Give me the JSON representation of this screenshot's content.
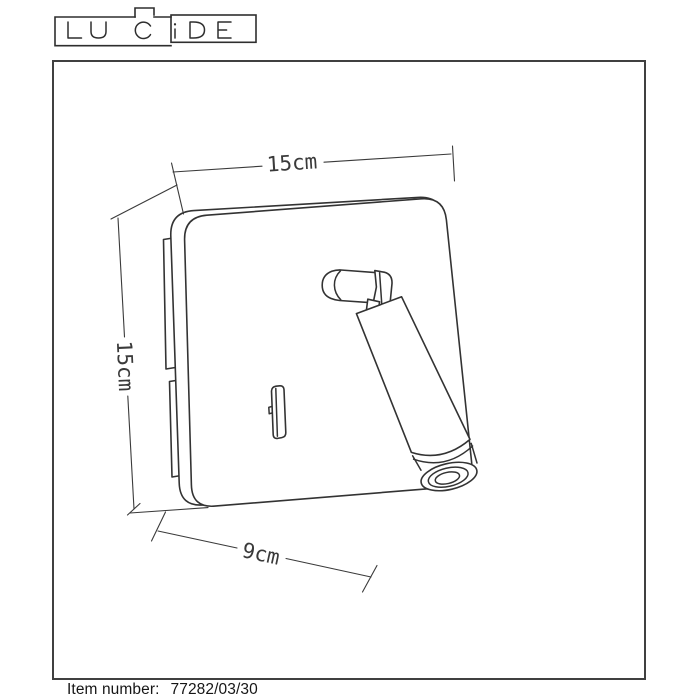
{
  "brand": {
    "name": "LUCIDE"
  },
  "dimensions": {
    "width": "15cm",
    "height": "15cm",
    "depth": "9cm"
  },
  "footer": {
    "item_label": "Item number:",
    "item_value": "77282/03/30"
  },
  "colors": {
    "line": "#333333",
    "dimension_line": "#3a3a3a",
    "frame": "#404040",
    "text": "#161616",
    "background": "#ffffff"
  }
}
